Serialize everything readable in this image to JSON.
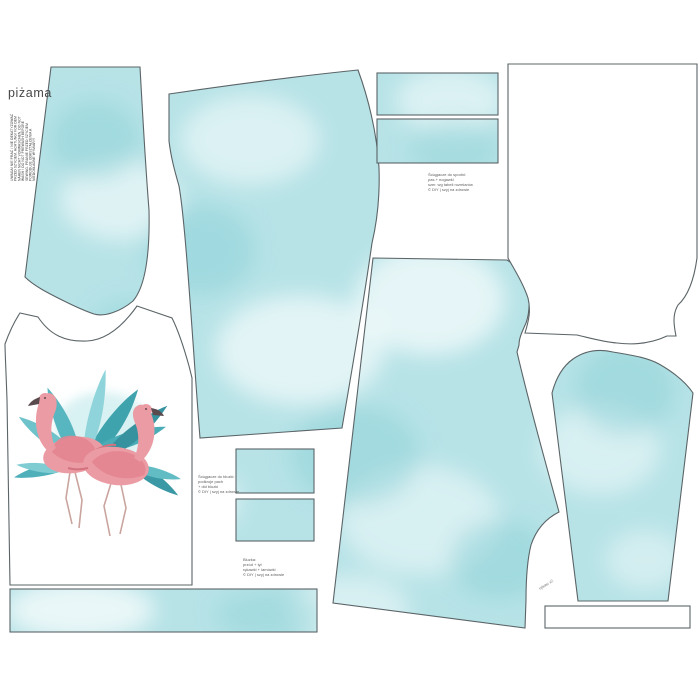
{
  "sheet": {
    "product_label": "piżama",
    "care_note_lines": [
      "UWAGA! NIE PRAĆ / NIE DEKATYZOWAĆ",
      "PRZED SZYCIEM. ACHTUNG! VOR DEM",
      "NÄHEN NICHT VORWASCHEN. DO NOT",
      "WASH / DO NOT PREWASH BEFORE",
      "SEWING. PRANIE PRZED SZYCIEM",
      "POWODUJE ODKSZTAŁCENIA A",
      "NIEDOKŁADNE WYMIARY!"
    ],
    "notes": {
      "waistband_note_lines": [
        "Ściągacze do spodni:",
        "pas + nogawki",
        "szer. wg tabeli rozmiarów",
        "© DIY | szyj na zdrowie"
      ],
      "cuff_note_lines": [
        "Ściągacze do bluzki:",
        "podkroje pach",
        "+ dół bluzki",
        "© DIY | szyj na zdrowie"
      ],
      "top_note_lines": [
        "Bluzka:",
        "przód + tył",
        "rękawki + lamówki",
        "© DIY | szyj na zdrowie"
      ],
      "sleeve_note": "rękaw x2"
    },
    "colors": {
      "fabric_teal": "#b7e3e7",
      "fabric_teal_deep": "#8ed2d8",
      "outline_gray": "#5b6467",
      "flamingo_pink": "#eb9ba3",
      "flamingo_dark_pink": "#d4727f",
      "leaf_teal": "#4fb0ba",
      "background": "#ffffff"
    }
  }
}
